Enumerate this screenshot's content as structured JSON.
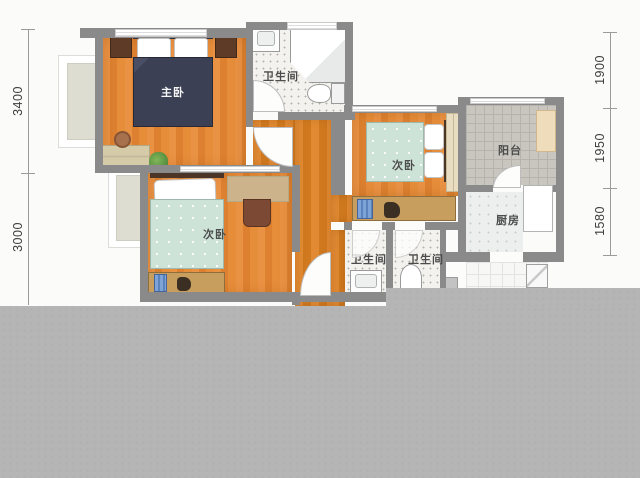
{
  "plan": {
    "title_hint": "apartment floor plan",
    "rooms": {
      "master_bedroom": "主卧",
      "bedroom_left": "次卧",
      "bedroom_right": "次卧",
      "bathroom_top": "卫生间",
      "bathroom_mid_left": "卫生间",
      "bathroom_mid_right": "卫生间",
      "balcony": "阳台",
      "kitchen": "厨房"
    },
    "dimensions_mm": {
      "left": [
        "3400",
        "3000"
      ],
      "right": [
        "1900",
        "1950",
        "1580"
      ]
    },
    "palette": {
      "wall": "#8a8a8a",
      "wood_floor": "#e08a38",
      "master_bed": "#3c4156",
      "guest_bed": "#cde3d8",
      "overlay_gray": "#b5b5b5"
    }
  }
}
